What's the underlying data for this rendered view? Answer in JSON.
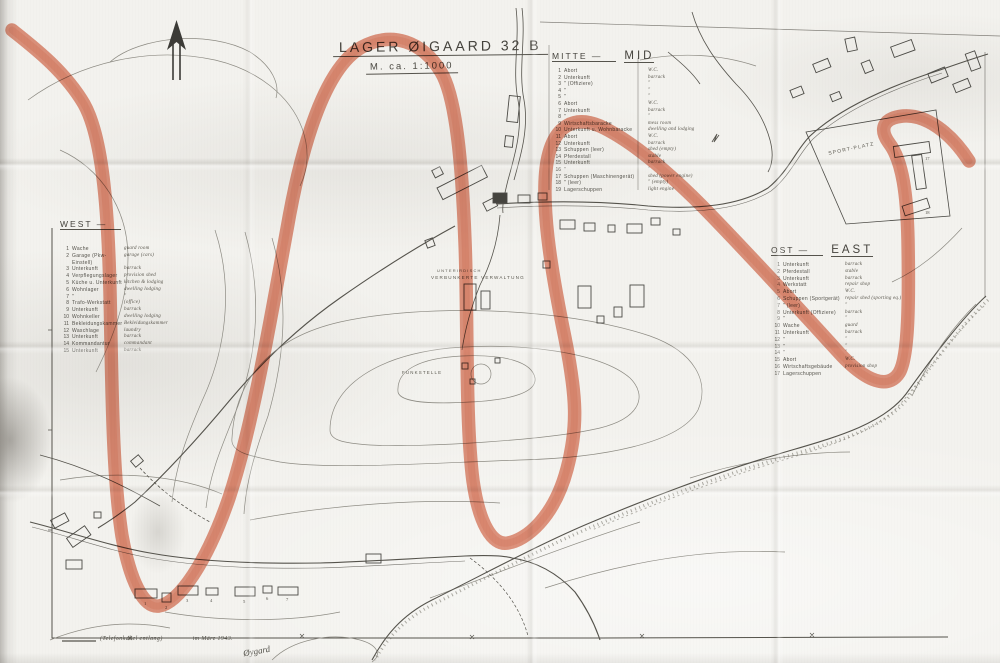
{
  "title": {
    "name": "LAGER ØIGAARD 32 B",
    "scale": "M. ca. 1:1000"
  },
  "north_arrow": "north-arrow",
  "legends": {
    "west": {
      "title": "WEST —",
      "rows": [
        {
          "n": "1",
          "de": "Wache",
          "en": "guard room"
        },
        {
          "n": "2",
          "de": "Garage (Pkw-Einstell)",
          "en": "garage (cars)"
        },
        {
          "n": "3",
          "de": "Unterkunft",
          "en": "barrack"
        },
        {
          "n": "4",
          "de": "Verpflegungslager",
          "en": "provision shed"
        },
        {
          "n": "5",
          "de": "Küche u. Unterkunft",
          "en": "kitchen & lodging"
        },
        {
          "n": "6",
          "de": "Wohnlager",
          "en": "dwelling lodging"
        },
        {
          "n": "7",
          "de": "\"",
          "en": "\""
        },
        {
          "n": "8",
          "de": "Trafo-Werkstatt",
          "en": "(office)"
        },
        {
          "n": "9",
          "de": "Unterkunft",
          "en": "barrack"
        },
        {
          "n": "10",
          "de": "Wohnkeller",
          "en": "dwelling lodging"
        },
        {
          "n": "11",
          "de": "Bekleidungskammer",
          "en": "Bekleidungskammer"
        },
        {
          "n": "12",
          "de": "Waschlage",
          "en": "laundry"
        },
        {
          "n": "13",
          "de": "Unterkunft",
          "en": "barrack"
        },
        {
          "n": "14",
          "de": "Kommandantur",
          "en": "commandant"
        },
        {
          "n": "15",
          "de": "Unterkunft",
          "en": "barrack"
        }
      ]
    },
    "mitte": {
      "title_de": "MITTE —",
      "title_en": "MID",
      "rows": [
        {
          "n": "1",
          "de": "Abort",
          "en": "W.C."
        },
        {
          "n": "2",
          "de": "Unterkunft",
          "en": "barrack"
        },
        {
          "n": "3",
          "de": "\"   (Offiziere)",
          "en": "\""
        },
        {
          "n": "4",
          "de": "\"",
          "en": "\""
        },
        {
          "n": "5",
          "de": "\"",
          "en": "\""
        },
        {
          "n": "6",
          "de": "Abort",
          "en": "W.C."
        },
        {
          "n": "7",
          "de": "Unterkunft",
          "en": "barrack"
        },
        {
          "n": "8",
          "de": "\"",
          "en": "\""
        },
        {
          "n": "9",
          "de": "Wirtschaftsbaracke",
          "en": "mess room"
        },
        {
          "n": "10",
          "de": "Unterkunft u. Wohnbaracke",
          "en": "dwelling and lodging"
        },
        {
          "n": "11",
          "de": "Abort",
          "en": "W.C."
        },
        {
          "n": "12",
          "de": "Unterkunft",
          "en": "barrack"
        },
        {
          "n": "13",
          "de": "Schuppen (leer)",
          "en": "shed (empty)"
        },
        {
          "n": "14",
          "de": "Pferdestall",
          "en": "stable"
        },
        {
          "n": "15",
          "de": "Unterkunft",
          "en": "barrack"
        },
        {
          "n": "16",
          "de": "\"",
          "en": "\""
        },
        {
          "n": "17",
          "de": "Schuppen (Maschinengerät)",
          "en": "shed (power engine)"
        },
        {
          "n": "18",
          "de": "\"   (leer)",
          "en": "\"  (empty)"
        },
        {
          "n": "19",
          "de": "Lagerschuppen",
          "en": "light engine"
        }
      ]
    },
    "ost": {
      "title_de": "OST —",
      "title_en": "EAST",
      "rows": [
        {
          "n": "1",
          "de": "Unterkunft",
          "en": "barrack"
        },
        {
          "n": "2",
          "de": "Pferdestall",
          "en": "stable"
        },
        {
          "n": "3",
          "de": "Unterkunft",
          "en": "barrack"
        },
        {
          "n": "4",
          "de": "Werkstatt",
          "en": "repair shop"
        },
        {
          "n": "5",
          "de": "Abort",
          "en": "W.C."
        },
        {
          "n": "6",
          "de": "Schuppen (Sportgerät)",
          "en": "repair shed (sporting eq.)"
        },
        {
          "n": "7",
          "de": "\"   (leer)",
          "en": "\""
        },
        {
          "n": "8",
          "de": "Unterkunft (Offiziere)",
          "en": "barrack"
        },
        {
          "n": "9",
          "de": "\"",
          "en": "\""
        },
        {
          "n": "10",
          "de": "Wache",
          "en": "guard"
        },
        {
          "n": "11",
          "de": "Unterkunft",
          "en": "barrack"
        },
        {
          "n": "12",
          "de": "\"",
          "en": "\""
        },
        {
          "n": "13",
          "de": "\"",
          "en": "\""
        },
        {
          "n": "14",
          "de": "\"",
          "en": "\""
        },
        {
          "n": "15",
          "de": "Abort",
          "en": "W.C."
        },
        {
          "n": "16",
          "de": "Wirtschaftsgebäude",
          "en": "provision shop"
        },
        {
          "n": "17",
          "de": "Lagerschuppen",
          "en": ""
        }
      ]
    }
  },
  "map_labels": {
    "sportplatz": "SPORT-PLATZ",
    "underground_1": "UNTERIRDISCH",
    "underground_2": "VERBUNKERTE VERWALTUNG",
    "funkstelle": "FUNKSTELLE"
  },
  "map": {
    "numbers": [
      "1",
      "2",
      "3",
      "4",
      "5",
      "6",
      "7",
      "17",
      "18"
    ]
  },
  "footer": {
    "cable_note": "(Telefonkabel entlang)",
    "date_note": "im März 1943.",
    "signature": "Øygard"
  },
  "annotation": {
    "marker_color": "#d96f52",
    "description": "hand-drawn red marker scribble"
  }
}
